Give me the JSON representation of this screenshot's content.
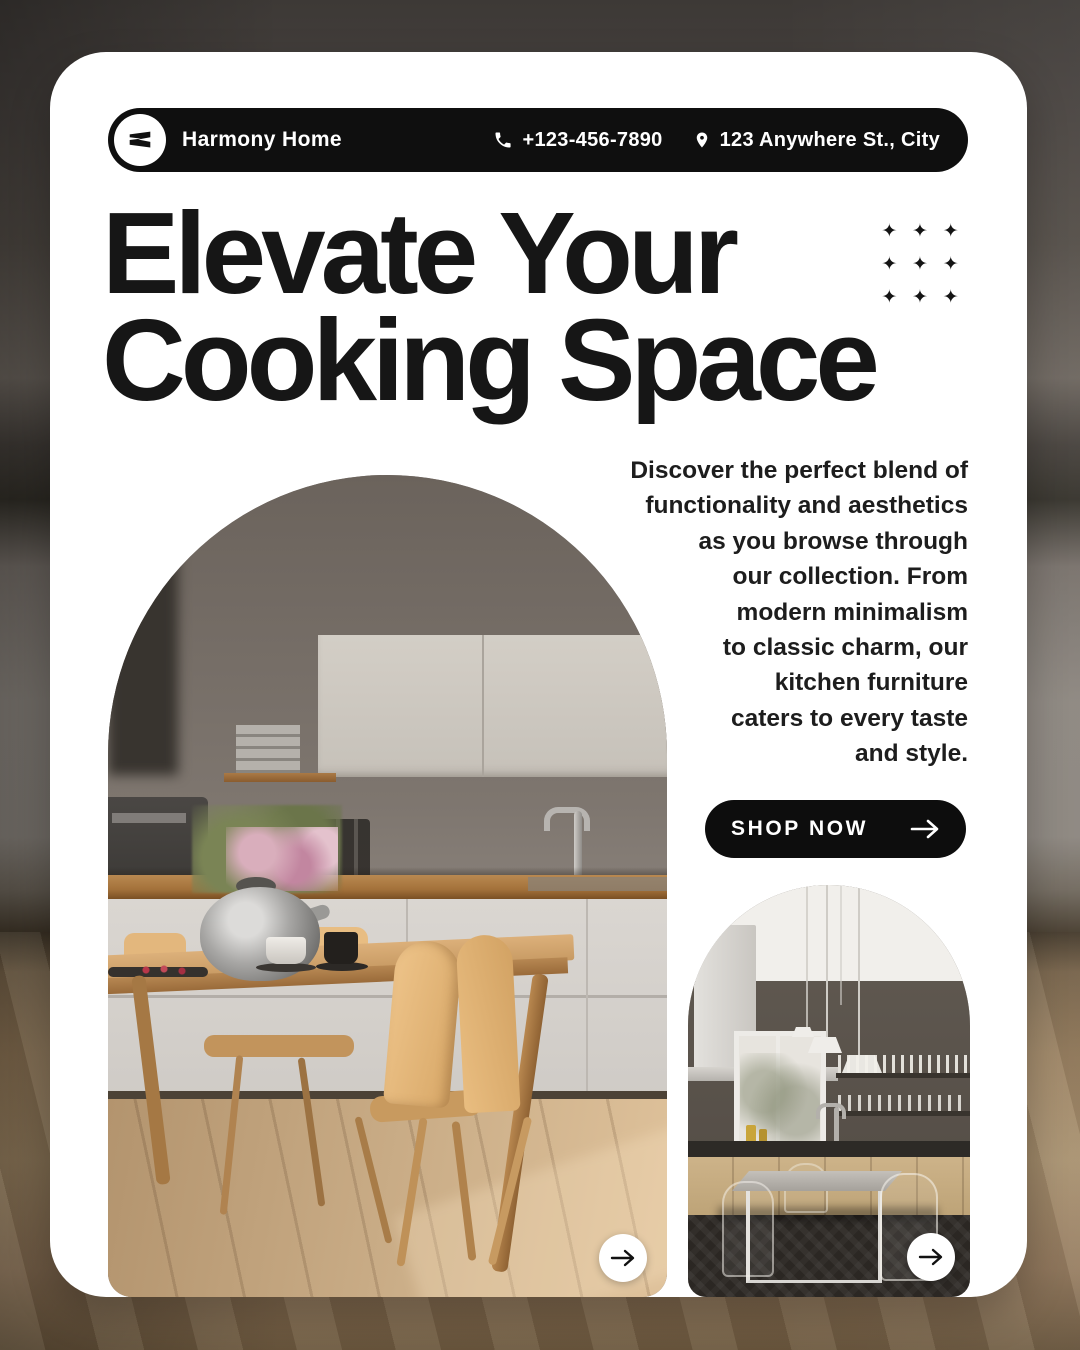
{
  "header": {
    "brand": "Harmony Home",
    "phone": "+123-456-7890",
    "address": "123 Anywhere St., City"
  },
  "headline": "Elevate Your\nCooking Space",
  "description": "Discover the perfect blend of\nfunctionality and aesthetics\nas you browse through\nour collection. From\nmodern minimalism\nto classic charm, our\nkitchen furniture\ncaters to every taste\nand style.",
  "cta": {
    "label": "SHOP NOW"
  },
  "decor": {
    "sparkle_glyph": "✦"
  },
  "icons": {
    "logo": "brand-logo-icon",
    "phone": "phone-icon",
    "location": "location-pin-icon",
    "arrow": "arrow-right-icon"
  },
  "colors": {
    "card": "#ffffff",
    "pill": "#0f0f0f",
    "ink": "#161616",
    "cta": "#0d0d0d"
  }
}
